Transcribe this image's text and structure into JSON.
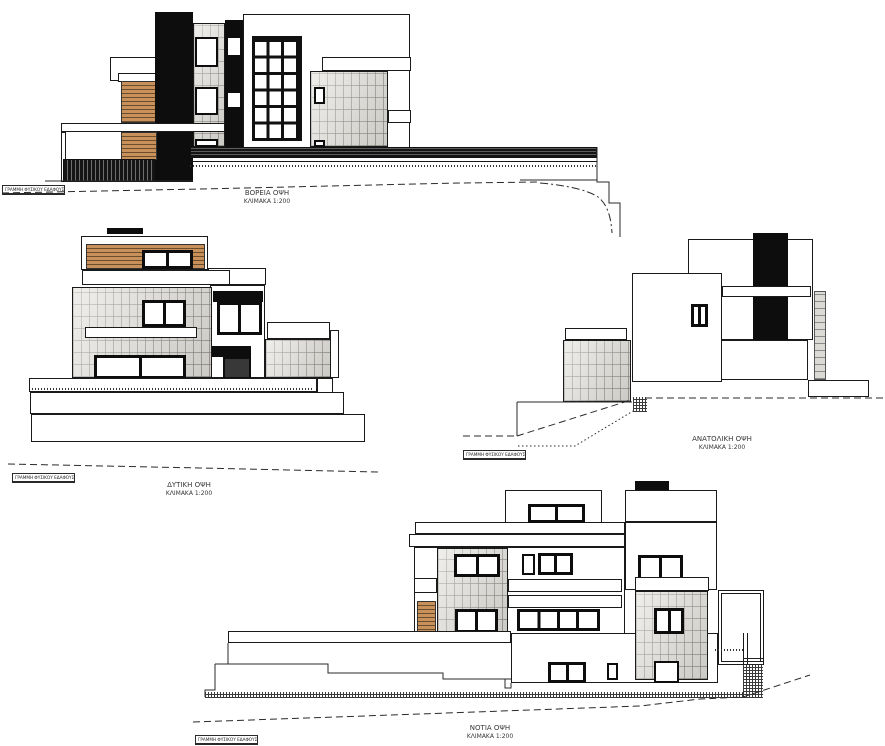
{
  "sheet": {
    "kind": "architectural-elevations-drawing",
    "ground_line_label": "ΓΡΑΜΜΗ ΦΥΣΙΚΟΥ ΕΔΑΦΟΥΣ",
    "elevations": [
      {
        "id": "north",
        "title": "ΒΟΡΕΙΑ ΟΨΗ",
        "scale_label": "ΚΛΙΜΑΚΑ 1:200"
      },
      {
        "id": "west",
        "title": "ΔΥΤΙΚΗ ΟΨΗ",
        "scale_label": "ΚΛΙΜΑΚΑ 1:200"
      },
      {
        "id": "east",
        "title": "ΑΝΑΤΟΛΙΚΗ ΟΨΗ",
        "scale_label": "ΚΛΙΜΑΚΑ 1:200"
      },
      {
        "id": "south",
        "title": "ΝΟΤΙΑ ΟΨΗ",
        "scale_label": "ΚΛΙΜΑΚΑ 1:200"
      }
    ],
    "materials": {
      "wood": "#c8905a",
      "masonry": "#dcdad5",
      "masonry_joint": "#9b9994",
      "accent_black": "#0d0d0d",
      "line": "#1a1a1a"
    }
  }
}
